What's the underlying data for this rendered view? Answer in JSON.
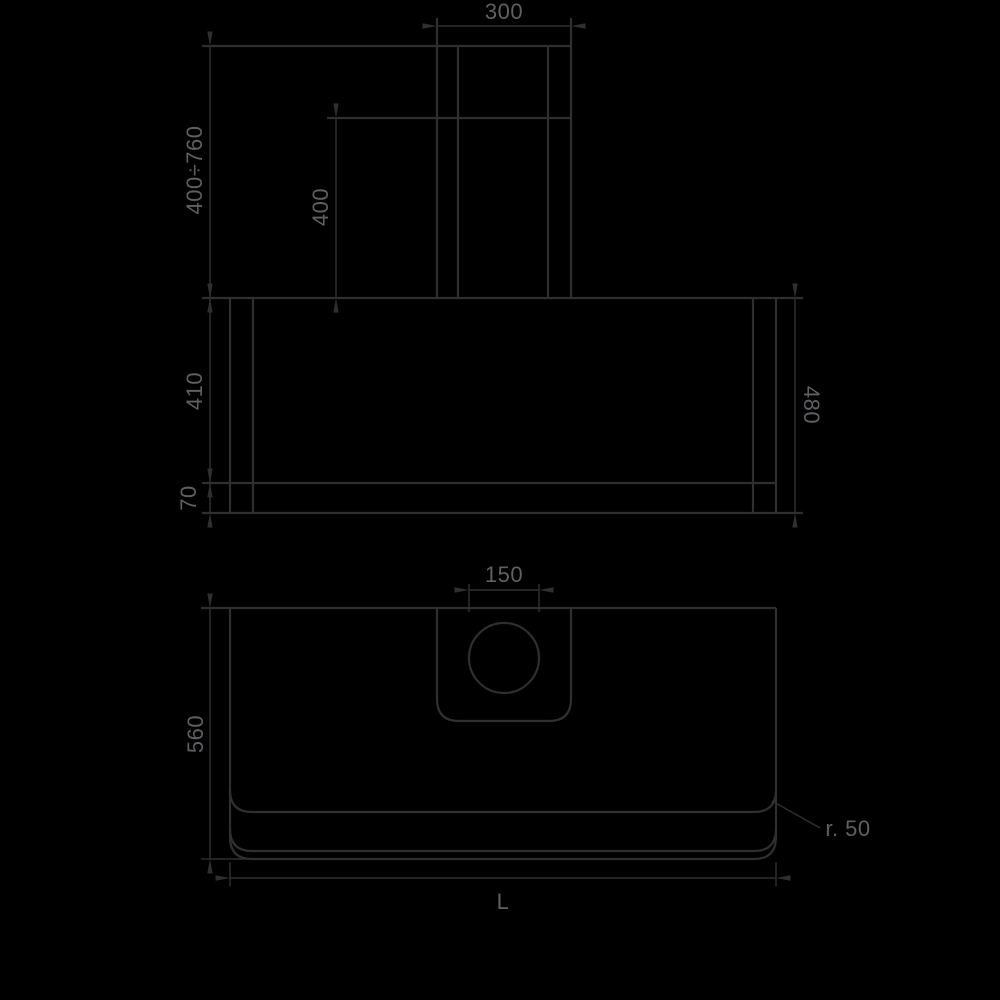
{
  "page": {
    "background": "#000000"
  },
  "drawing": {
    "line_color": "#2f2f31",
    "text_color": "#606064",
    "labels": {
      "chimney_width": "300",
      "height_range": "400÷760",
      "chimney_lower_height": "400",
      "body_height": "410",
      "band_height": "70",
      "total_height": "480",
      "outlet_diameter": "150",
      "depth": "560",
      "corner_radius": "r. 50",
      "length": "L"
    }
  }
}
